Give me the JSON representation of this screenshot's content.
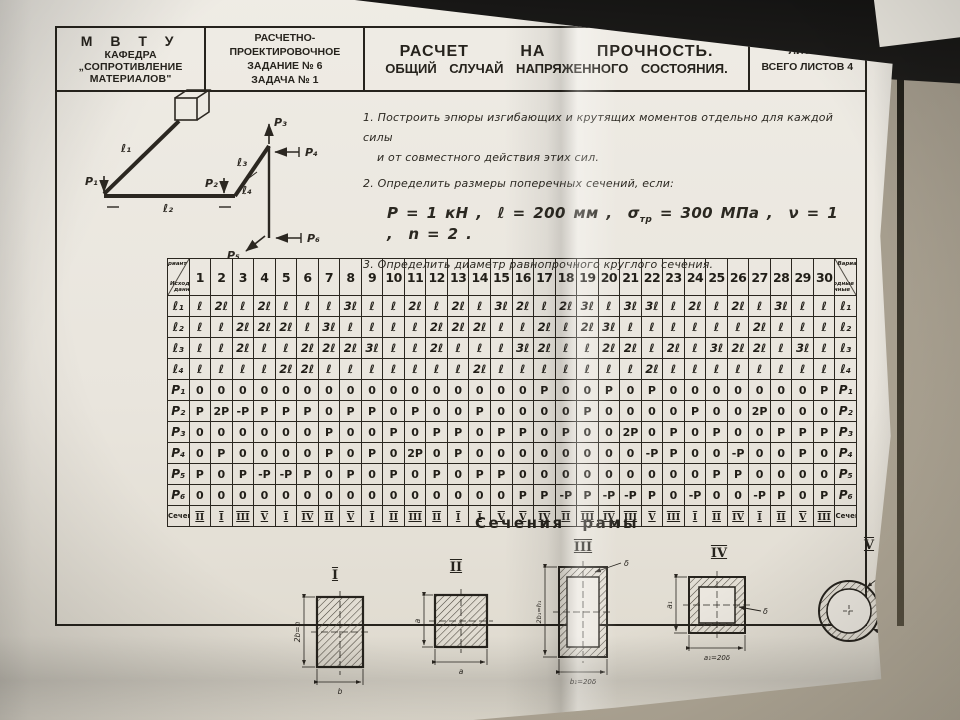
{
  "header": {
    "org_line1": "М В Т У",
    "org_line2": "КАФЕДРА „СОПРОТИВЛЕНИЕ",
    "org_line3": "МАТЕРИАЛОВ\"",
    "task_line1": "РАСЧЕТНО-ПРОЕКТИРОВОЧНОЕ",
    "task_line2": "ЗАДАНИЕ № 6",
    "task_line3": "ЗАДАЧА  № 1",
    "title_line1": "РАСЧЕТ НА ПРОЧНОСТЬ.",
    "title_line2": "ОБЩИЙ СЛУЧАЙ НАПРЯЖЕННОГО СОСТОЯНИЯ.",
    "sheet_line1": "ЛИСТ 1",
    "sheet_line2": "ВСЕГО  ЛИСТОВ 4"
  },
  "tasks": {
    "item1_line1": "1. Построить эпюры изгибающих и крутящих моментов  отдельно для каждой силы",
    "item1_line2": "и от совместного действия этих сил.",
    "item2": "2. Определить размеры поперечных сечений, если:",
    "formula_p": "P = 1 кН ,",
    "formula_l": "ℓ = 200 мм ,",
    "formula_sigma": "σ",
    "formula_sigma_sub": "тр",
    "formula_sigma_val": "= 300 МПа ,",
    "formula_nu": "ν = 1 ,",
    "formula_n": "n = 2 .",
    "item3": "3. Определить диаметр равнопрочного круглого сечения."
  },
  "diagram": {
    "p1": "P₁",
    "p2": "P₂",
    "p3": "P₃",
    "p4": "P₄",
    "p5": "P₅",
    "p6": "P₆",
    "l1": "ℓ₁",
    "l2": "ℓ₂",
    "l3": "ℓ₃",
    "l4": "ℓ₄"
  },
  "table": {
    "corner_top": "Вариант",
    "corner_bottom": "Исходные данные",
    "variants": [
      "1",
      "2",
      "3",
      "4",
      "5",
      "6",
      "7",
      "8",
      "9",
      "10",
      "11",
      "12",
      "13",
      "14",
      "15",
      "16",
      "17",
      "18",
      "19",
      "20",
      "21",
      "22",
      "23",
      "24",
      "25",
      "26",
      "27",
      "28",
      "29",
      "30"
    ],
    "rows": [
      {
        "label": "ℓ₁",
        "kind": "l",
        "values": [
          "ℓ",
          "2ℓ",
          "ℓ",
          "2ℓ",
          "ℓ",
          "ℓ",
          "ℓ",
          "3ℓ",
          "ℓ",
          "ℓ",
          "2ℓ",
          "ℓ",
          "2ℓ",
          "ℓ",
          "3ℓ",
          "2ℓ",
          "ℓ",
          "2ℓ",
          "3ℓ",
          "ℓ",
          "3ℓ",
          "3ℓ",
          "ℓ",
          "2ℓ",
          "ℓ",
          "2ℓ",
          "ℓ",
          "3ℓ",
          "ℓ",
          "ℓ"
        ]
      },
      {
        "label": "ℓ₂",
        "kind": "l",
        "values": [
          "ℓ",
          "ℓ",
          "2ℓ",
          "2ℓ",
          "2ℓ",
          "ℓ",
          "3ℓ",
          "ℓ",
          "ℓ",
          "ℓ",
          "ℓ",
          "2ℓ",
          "2ℓ",
          "2ℓ",
          "ℓ",
          "ℓ",
          "2ℓ",
          "ℓ",
          "2ℓ",
          "3ℓ",
          "ℓ",
          "ℓ",
          "ℓ",
          "ℓ",
          "ℓ",
          "ℓ",
          "2ℓ",
          "ℓ",
          "ℓ",
          "ℓ"
        ]
      },
      {
        "label": "ℓ₃",
        "kind": "l",
        "values": [
          "ℓ",
          "ℓ",
          "2ℓ",
          "ℓ",
          "ℓ",
          "2ℓ",
          "2ℓ",
          "2ℓ",
          "3ℓ",
          "ℓ",
          "ℓ",
          "2ℓ",
          "ℓ",
          "ℓ",
          "ℓ",
          "3ℓ",
          "2ℓ",
          "ℓ",
          "ℓ",
          "2ℓ",
          "2ℓ",
          "ℓ",
          "2ℓ",
          "ℓ",
          "3ℓ",
          "2ℓ",
          "2ℓ",
          "ℓ",
          "3ℓ",
          "ℓ"
        ]
      },
      {
        "label": "ℓ₄",
        "kind": "l",
        "values": [
          "ℓ",
          "ℓ",
          "ℓ",
          "ℓ",
          "2ℓ",
          "2ℓ",
          "ℓ",
          "ℓ",
          "ℓ",
          "ℓ",
          "ℓ",
          "ℓ",
          "ℓ",
          "2ℓ",
          "ℓ",
          "ℓ",
          "ℓ",
          "ℓ",
          "ℓ",
          "ℓ",
          "ℓ",
          "2ℓ",
          "ℓ",
          "ℓ",
          "ℓ",
          "ℓ",
          "ℓ",
          "ℓ",
          "ℓ",
          "ℓ"
        ]
      },
      {
        "label": "P₁",
        "kind": "p",
        "values": [
          "0",
          "0",
          "0",
          "0",
          "0",
          "0",
          "0",
          "0",
          "0",
          "0",
          "0",
          "0",
          "0",
          "0",
          "0",
          "0",
          "P",
          "0",
          "0",
          "P",
          "0",
          "P",
          "0",
          "0",
          "0",
          "0",
          "0",
          "0",
          "0",
          "P"
        ]
      },
      {
        "label": "P₂",
        "kind": "p",
        "values": [
          "P",
          "2P",
          "-P",
          "P",
          "P",
          "P",
          "0",
          "P",
          "P",
          "0",
          "P",
          "0",
          "0",
          "P",
          "0",
          "0",
          "0",
          "0",
          "P",
          "0",
          "0",
          "0",
          "0",
          "P",
          "0",
          "0",
          "2P",
          "0",
          "0",
          "0"
        ]
      },
      {
        "label": "P₃",
        "kind": "p",
        "values": [
          "0",
          "0",
          "0",
          "0",
          "0",
          "0",
          "P",
          "0",
          "0",
          "P",
          "0",
          "P",
          "P",
          "0",
          "P",
          "P",
          "0",
          "P",
          "0",
          "0",
          "2P",
          "0",
          "P",
          "0",
          "P",
          "0",
          "0",
          "P",
          "P",
          "P"
        ]
      },
      {
        "label": "P₄",
        "kind": "p",
        "values": [
          "0",
          "P",
          "0",
          "0",
          "0",
          "0",
          "P",
          "0",
          "P",
          "0",
          "2P",
          "0",
          "P",
          "0",
          "0",
          "0",
          "0",
          "0",
          "0",
          "0",
          "0",
          "-P",
          "P",
          "0",
          "0",
          "-P",
          "0",
          "0",
          "P",
          "0"
        ]
      },
      {
        "label": "P₅",
        "kind": "p",
        "values": [
          "P",
          "0",
          "P",
          "-P",
          "-P",
          "P",
          "0",
          "P",
          "0",
          "P",
          "0",
          "P",
          "0",
          "P",
          "P",
          "0",
          "0",
          "0",
          "0",
          "0",
          "0",
          "0",
          "0",
          "0",
          "P",
          "P",
          "0",
          "0",
          "0",
          "0"
        ]
      },
      {
        "label": "P₆",
        "kind": "p",
        "values": [
          "0",
          "0",
          "0",
          "0",
          "0",
          "0",
          "0",
          "0",
          "0",
          "0",
          "0",
          "0",
          "0",
          "0",
          "0",
          "P",
          "P",
          "-P",
          "P",
          "-P",
          "-P",
          "P",
          "0",
          "-P",
          "0",
          "0",
          "-P",
          "P",
          "0",
          "P"
        ]
      },
      {
        "label": "Сечения",
        "kind": "roman",
        "values": [
          "II",
          "I",
          "III",
          "V",
          "I",
          "IV",
          "II",
          "V",
          "I",
          "II",
          "III",
          "II",
          "I",
          "I",
          "V",
          "V",
          "IV",
          "II",
          "III",
          "IV",
          "III",
          "V",
          "III",
          "I",
          "II",
          "IV",
          "I",
          "II",
          "V",
          "III"
        ]
      }
    ]
  },
  "frame_sections": {
    "title": "Сечения рамы",
    "items": [
      {
        "numeral": "I",
        "dim_left": "2b=h",
        "dim_bottom": "b"
      },
      {
        "numeral": "II",
        "dim_left": "a",
        "dim_bottom": "a"
      },
      {
        "numeral": "III",
        "dim_left": "2b₁=h₁",
        "dim_bottom": "b₁=20δ",
        "dim_thick": "δ"
      },
      {
        "numeral": "IV",
        "dim_left": "a₁",
        "dim_bottom": "a₁=20δ",
        "dim_thick": "δ"
      },
      {
        "numeral": "V",
        "dim_top": "dср=20δ",
        "dim_thick": "δ"
      }
    ]
  }
}
